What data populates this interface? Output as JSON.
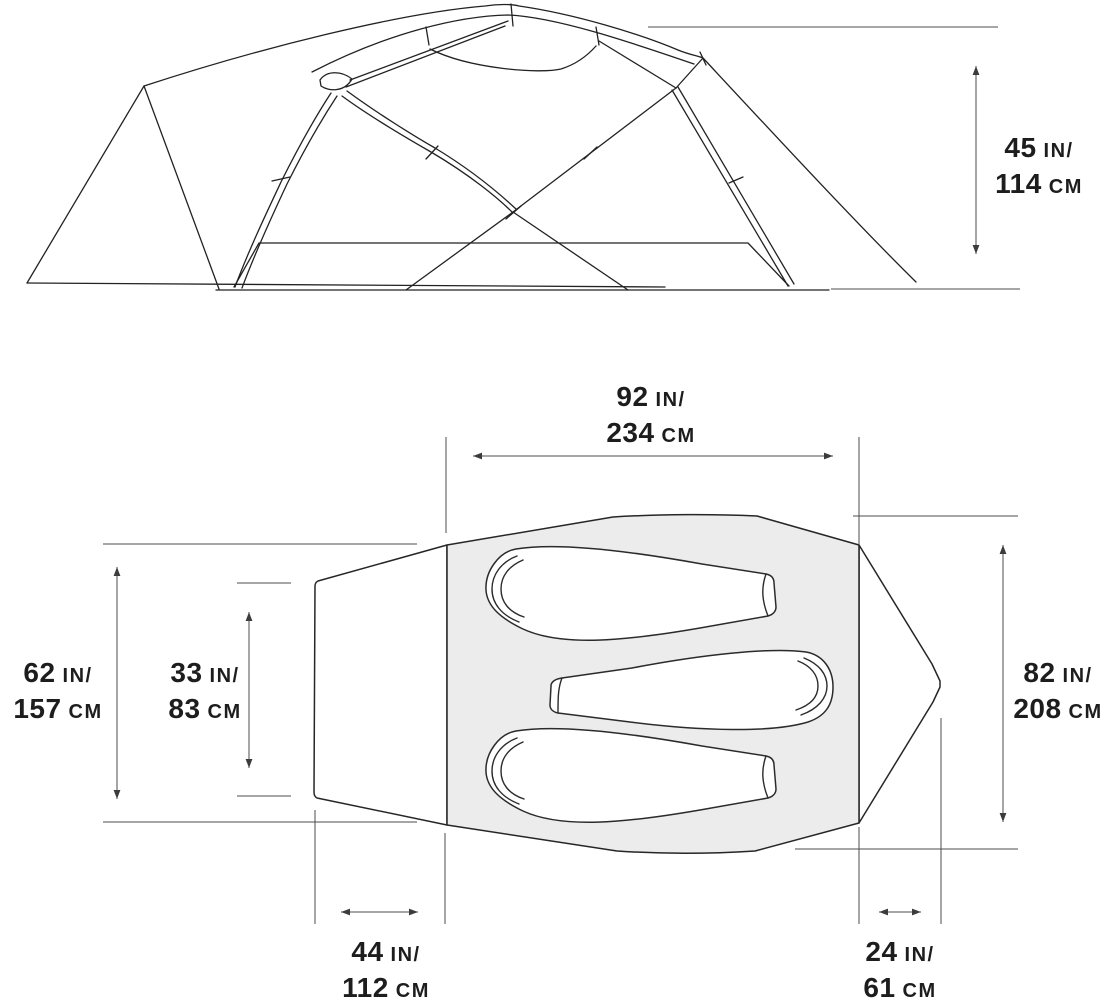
{
  "colors": {
    "ink": "#222222",
    "guide": "#4c4c4c",
    "body_fill": "#ececec",
    "background": "#ffffff",
    "text": "#1d1d1d"
  },
  "measurements": {
    "peak_height": {
      "in": "45",
      "in_unit": "IN/",
      "cm": "114",
      "cm_unit": "CM"
    },
    "floor_length": {
      "in": "92",
      "in_unit": "IN/",
      "cm": "234",
      "cm_unit": "CM"
    },
    "vestibule_width": {
      "in": "62",
      "in_unit": "IN/",
      "cm": "157",
      "cm_unit": "CM"
    },
    "door_width": {
      "in": "33",
      "in_unit": "IN/",
      "cm": "83",
      "cm_unit": "CM"
    },
    "floor_width": {
      "in": "82",
      "in_unit": "IN/",
      "cm": "208",
      "cm_unit": "CM"
    },
    "rear_vestibule_depth": {
      "in": "44",
      "in_unit": "IN/",
      "cm": "112",
      "cm_unit": "CM"
    },
    "front_vestibule_depth": {
      "in": "24",
      "in_unit": "IN/",
      "cm": "61",
      "cm_unit": "CM"
    }
  }
}
